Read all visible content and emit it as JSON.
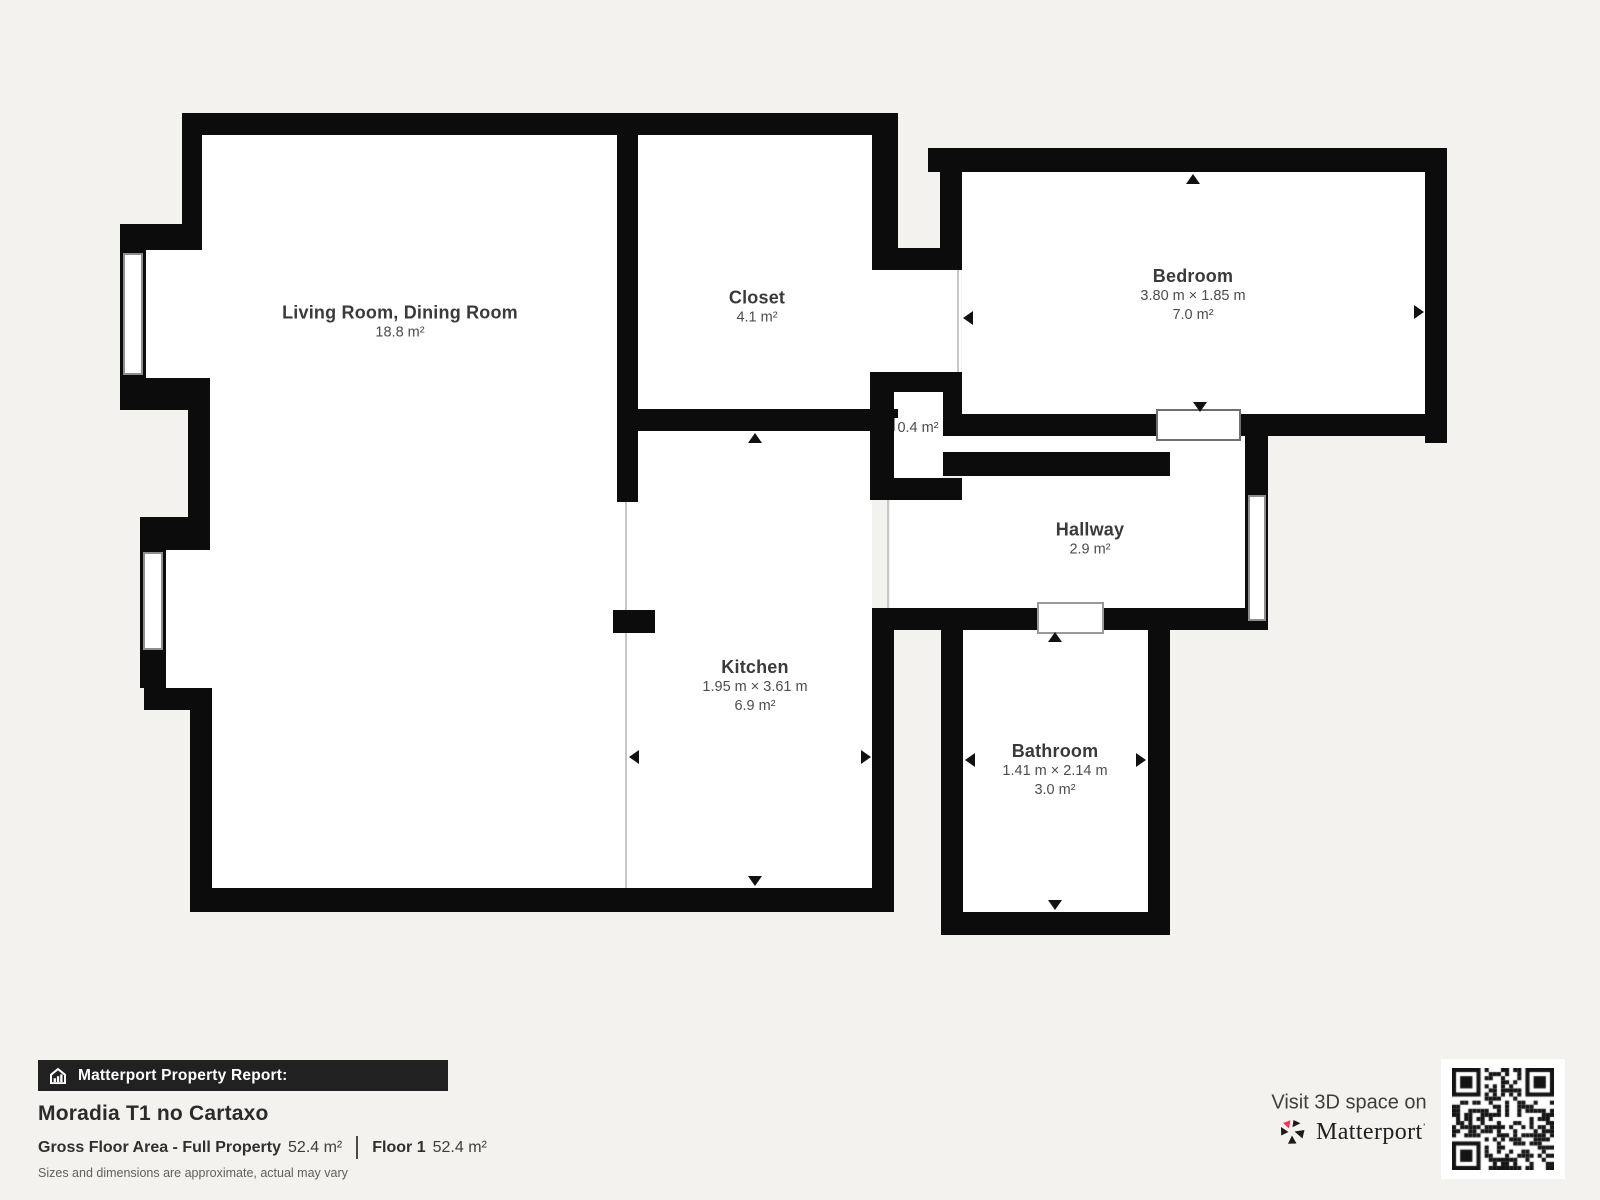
{
  "colors": {
    "background": "#f4f2ef",
    "wall": "#0c0c0c",
    "accent_red": "#ff3158"
  },
  "floorplan": {
    "rooms": [
      {
        "id": "living-room",
        "name": "Living Room, Dining Room",
        "area": "18.8 m²"
      },
      {
        "id": "closet",
        "name": "Closet",
        "area": "4.1 m²"
      },
      {
        "id": "bedroom",
        "name": "Bedroom",
        "dimensions": "3.80 m × 1.85 m",
        "area": "7.0 m²"
      },
      {
        "id": "small-closet",
        "name": "",
        "area": "0.4 m²"
      },
      {
        "id": "hallway",
        "name": "Hallway",
        "area": "2.9 m²"
      },
      {
        "id": "kitchen",
        "name": "Kitchen",
        "dimensions": "1.95 m × 3.61 m",
        "area": "6.9 m²"
      },
      {
        "id": "bathroom",
        "name": "Bathroom",
        "dimensions": "1.41 m × 2.14 m",
        "area": "3.0 m²"
      }
    ]
  },
  "report": {
    "banner_title": "Matterport Property Report:",
    "property_name": "Moradia T1 no Cartaxo",
    "gross_floor_area_label": "Gross Floor Area - Full Property",
    "gross_floor_area_value": "52.4 m²",
    "floor_label": "Floor 1",
    "floor_area_value": "52.4 m²",
    "disclaimer": "Sizes and dimensions are approximate, actual may vary"
  },
  "cta": {
    "visit_text": "Visit 3D space on",
    "brand": "Matterport"
  }
}
